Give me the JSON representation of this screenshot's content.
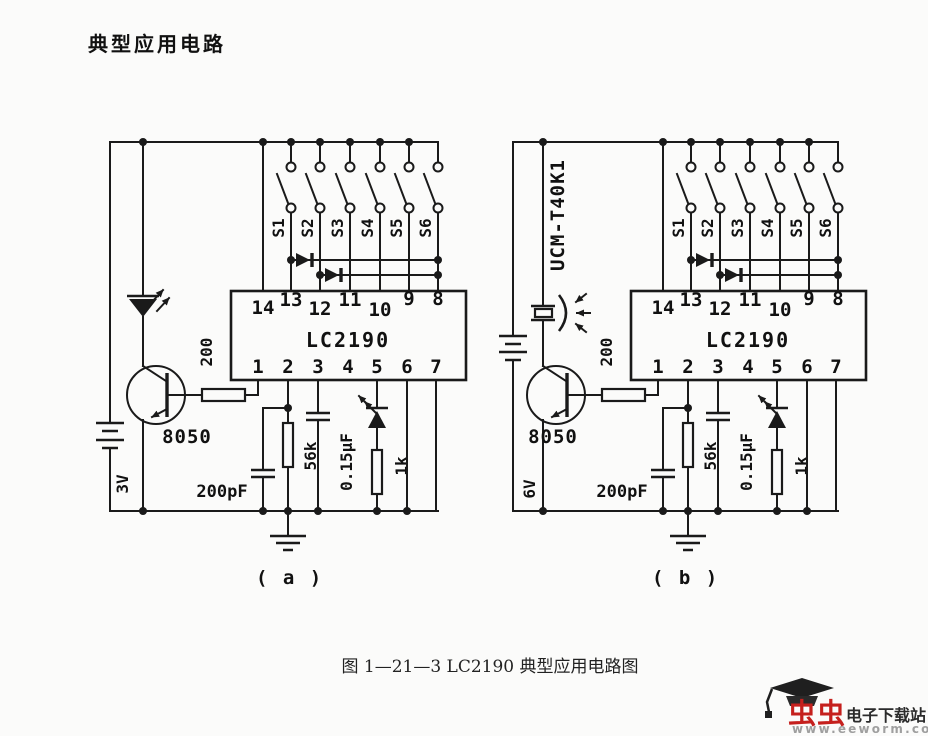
{
  "page": {
    "title": "典型应用电路",
    "figure_caption": "图 1—21—3  LC2190 典型应用电路图",
    "label_a": "( a )",
    "label_b": "( b )"
  },
  "circuit_a": {
    "switches": [
      "S1",
      "S2",
      "S3",
      "S4",
      "S5",
      "S6"
    ],
    "ic": {
      "name": "LC2190",
      "top_pins": [
        "14",
        "13",
        "12",
        "11",
        "10",
        "9",
        "8"
      ],
      "bottom_pins": [
        "1",
        "2",
        "3",
        "4",
        "5",
        "6",
        "7"
      ]
    },
    "transistor": "8050",
    "base_resistor": "200",
    "osc_capacitor": "200pF",
    "resistor_56k": "56k",
    "capacitor_015": "0.15µF",
    "resistor_1k": "1k",
    "battery": "3V"
  },
  "circuit_b": {
    "transducer": "UCM-T40K1",
    "switches": [
      "S1",
      "S2",
      "S3",
      "S4",
      "S5",
      "S6"
    ],
    "ic": {
      "name": "LC2190",
      "top_pins": [
        "14",
        "13",
        "12",
        "11",
        "10",
        "9",
        "8"
      ],
      "bottom_pins": [
        "1",
        "2",
        "3",
        "4",
        "5",
        "6",
        "7"
      ]
    },
    "transistor": "8050",
    "base_resistor": "200",
    "osc_capacitor": "200pF",
    "resistor_56k": "56k",
    "capacitor_015": "0.15µF",
    "resistor_1k": "1k",
    "battery": "6V"
  },
  "watermark": {
    "brand": "虫虫",
    "site": "电子下载站",
    "url": "www.eeworm.com"
  },
  "colors": {
    "ink": "#1a1a1a",
    "paper": "#fbfbfa",
    "brand_red": "#c5201d",
    "site_dark": "#2b2b2b",
    "url_gray": "#9f9f9f"
  }
}
